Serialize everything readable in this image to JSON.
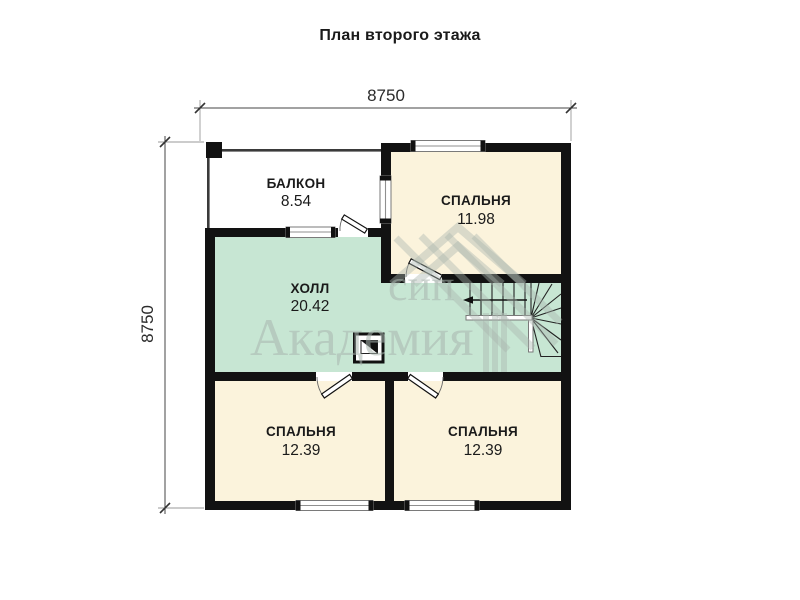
{
  "title": "План второго этажа",
  "dimensions": {
    "width": "8750",
    "height": "8750"
  },
  "rooms": [
    {
      "name": "БАЛКОН",
      "area": "8.54"
    },
    {
      "name": "СПАЛЬНЯ",
      "area": "11.98"
    },
    {
      "name": "ХОЛЛ",
      "area": "20.42"
    },
    {
      "name": "СПАЛЬНЯ",
      "area": "12.39"
    },
    {
      "name": "СПАЛЬНЯ",
      "area": "12.39"
    }
  ],
  "watermark": {
    "brand_line1": "сип",
    "brand_line2": "Академия"
  },
  "stairs": {
    "direction_arrow": "left"
  },
  "colors": {
    "wall": "#121212",
    "bedroom": "#fbf3dc",
    "hall": "#c7e6d3",
    "window_frame": "#8f8f8f",
    "watermark": "#a9b6af",
    "title_text": "#1a1a1a"
  }
}
